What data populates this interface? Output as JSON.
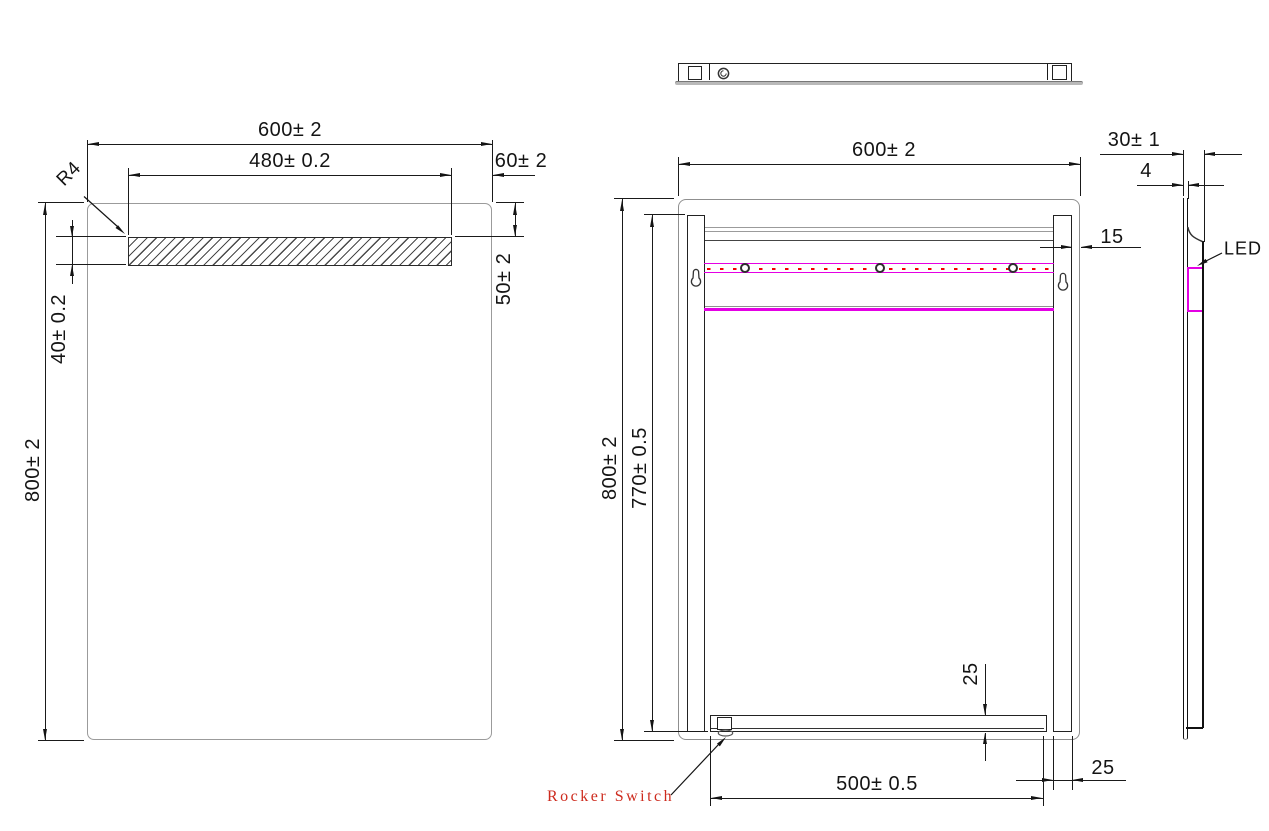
{
  "drawing_title": "LED mirror technical drawing",
  "front_view": {
    "width_dim": "600± 2",
    "window_width_dim": "480± 0.2",
    "right_gap_dim": "60± 2",
    "corner_radius_dim": "R4",
    "window_height_dim": "40± 0.2",
    "top_gap_dim": "50± 2",
    "height_dim": "800± 2"
  },
  "rear_view": {
    "width_dim": "600± 2",
    "height_dim": "800± 2",
    "rail_height_dim": "770± 0.5",
    "rail_edge_gap_dim": "15",
    "bar_height_dim": "25",
    "rail_width_dim": "25",
    "switch_span_dim": "500± 0.5",
    "rocker_switch_label": "Rocker Switch"
  },
  "side_view": {
    "depth_dim": "30± 1",
    "glass_thickness_dim": "4",
    "led_label": "LED"
  },
  "colors": {
    "line": "#1a1a1a",
    "mirror_outline": "#9b9b9b",
    "led_magenta": "#e400e4",
    "dash_red": "#f10000",
    "label_red": "#cd2b1e"
  }
}
